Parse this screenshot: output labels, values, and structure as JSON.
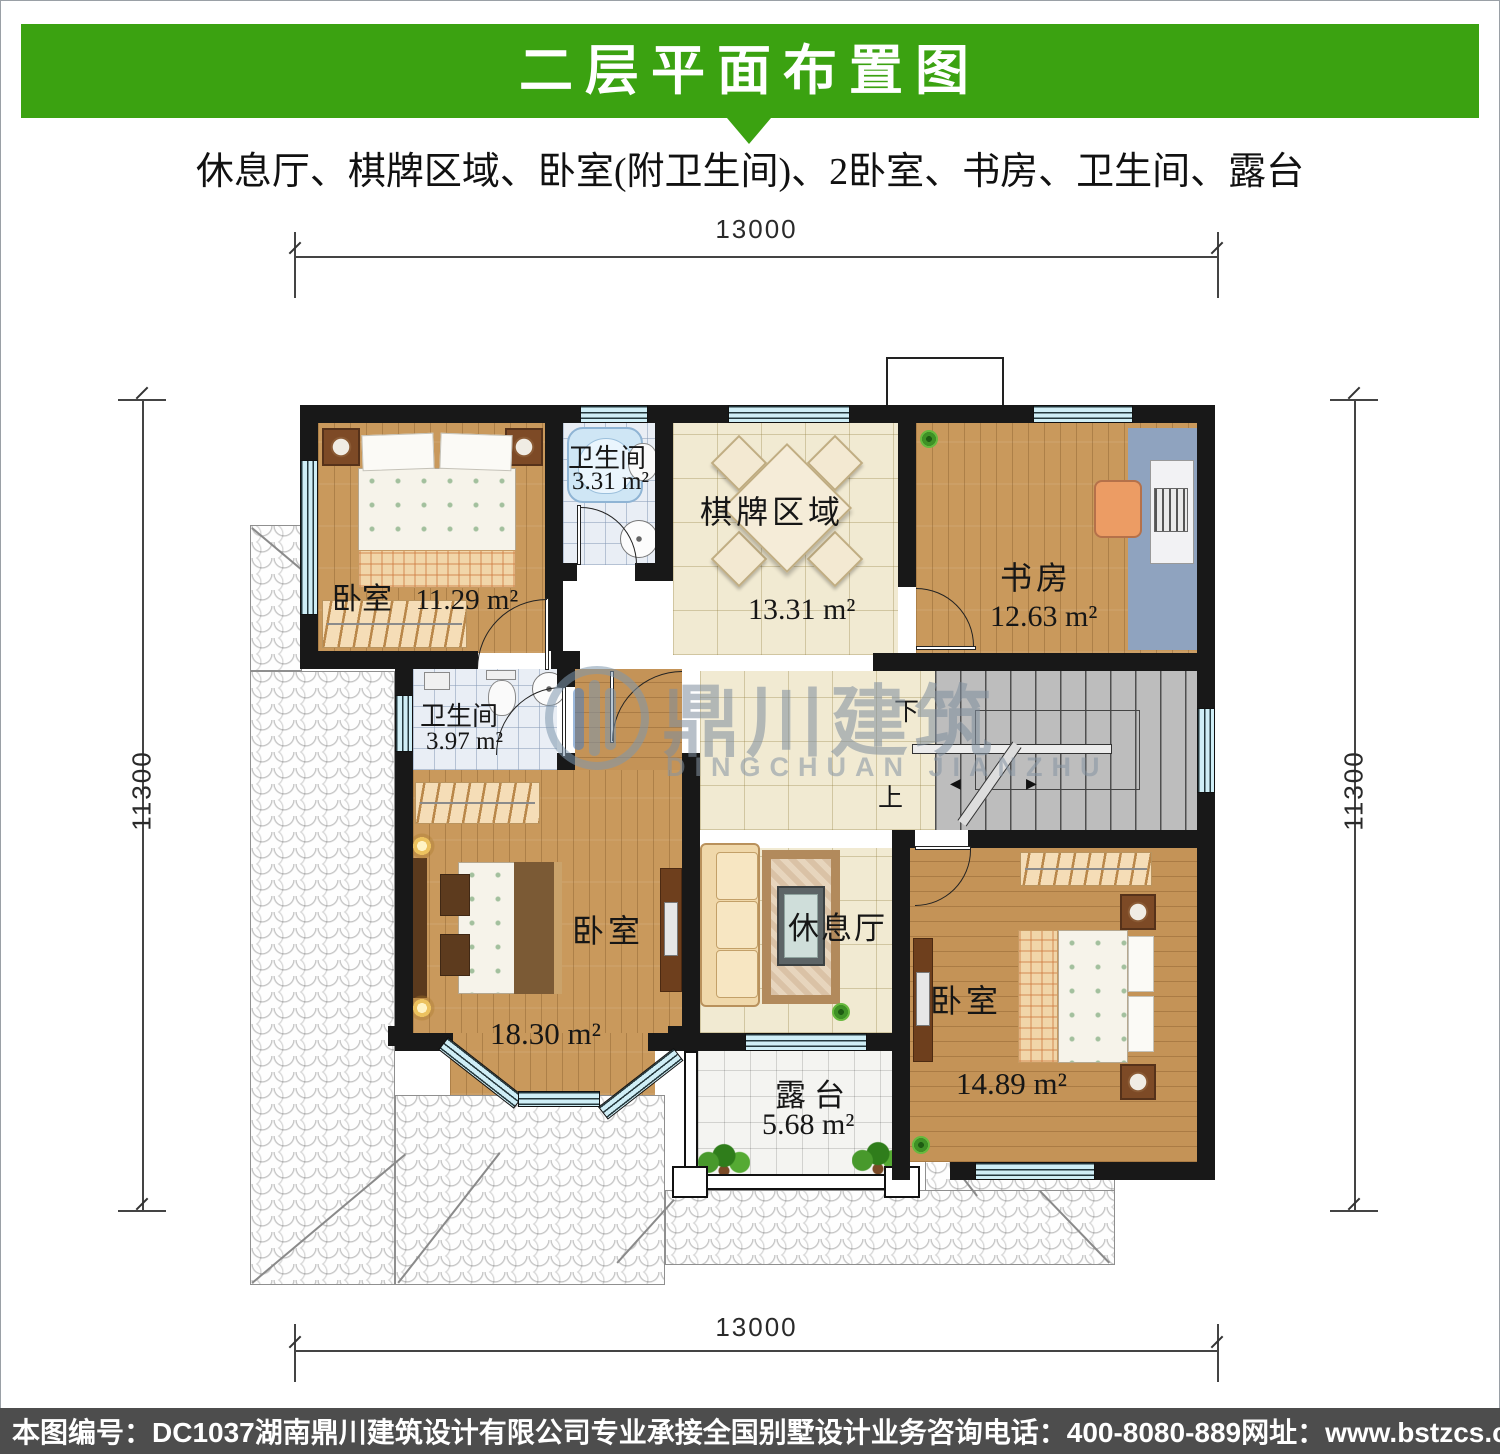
{
  "header": {
    "title": "二层平面布置图",
    "subtitle": "休息厅、棋牌区域、卧室(附卫生间)、2卧室、书房、卫生间、露台"
  },
  "colors": {
    "banner_green": "#3ba211",
    "footer_bar": "#4d4d4d",
    "wall_black": "#181818",
    "window_cyan": "#cfeef6"
  },
  "dimensions": {
    "top": "13000",
    "bottom": "13000",
    "left": "11300",
    "right": "11300"
  },
  "rooms": {
    "bedroom_top_left": {
      "name": "卧室",
      "area": "11.29 m²"
    },
    "bath_top": {
      "name": "卫生间",
      "area": "3.31 m²"
    },
    "chess_area": {
      "name": "棋牌区域",
      "area": "13.31 m²"
    },
    "study": {
      "name": "书房",
      "area": "12.63 m²"
    },
    "bath_mid": {
      "name": "卫生间",
      "area": "3.97 m²"
    },
    "bedroom_bottom_left": {
      "name": "卧室",
      "area": "18.30 m²"
    },
    "lounge": {
      "name": "休息厅"
    },
    "bedroom_bottom_right": {
      "name": "卧室",
      "area": "14.89 m²"
    },
    "terrace": {
      "name": "露台",
      "area": "5.68 m²"
    }
  },
  "stairs": {
    "down": "下",
    "up": "上"
  },
  "watermark": {
    "cn": "鼎川建筑",
    "en": "DINGCHUAN JIANZHU"
  },
  "footer": {
    "plan_no": "本图编号：DC1037",
    "company": "湖南鼎川建筑设计有限公司专业承接全国别墅设计业务",
    "phone": "咨询电话：400-8080-889",
    "website": "网址：www.bstzcs.com"
  }
}
